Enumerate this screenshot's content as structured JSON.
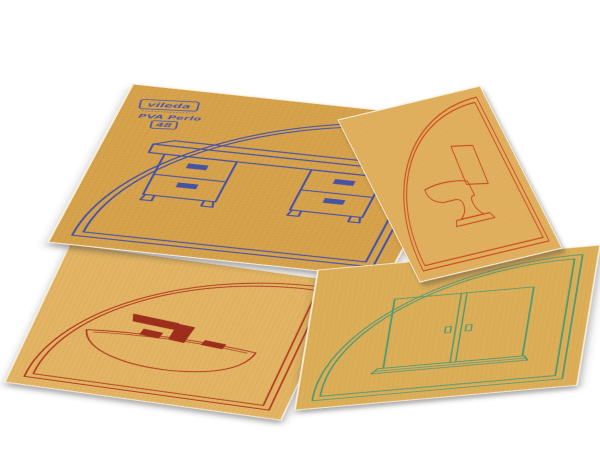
{
  "photo": {
    "background_color": "#ffffff",
    "stamp": {
      "brand": "vileda",
      "product": "PVA Perlo",
      "number": "48",
      "ink_color": "#3c50b0"
    },
    "sheets": [
      {
        "position": "top-left",
        "icon": "desk",
        "frame": "quarter-circle-double-line",
        "paper_color": "#d6a24b",
        "ink_color": "#4553a4"
      },
      {
        "position": "top-right",
        "icon": "toilet",
        "frame": "quarter-circle-double-line",
        "paper_color": "#e0b05e",
        "ink_color": "#cf4a1f"
      },
      {
        "position": "bottom-left",
        "icon": "washbasin",
        "frame": "quarter-circle-double-line",
        "paper_color": "#e2b464",
        "ink_color": "#b53a22",
        "fixture_color": "#9e2d1a"
      },
      {
        "position": "bottom-right",
        "icon": "cabinet",
        "frame": "quarter-circle-double-line",
        "paper_color": "#dcae58",
        "ink_color": "#4d9a74"
      }
    ]
  }
}
